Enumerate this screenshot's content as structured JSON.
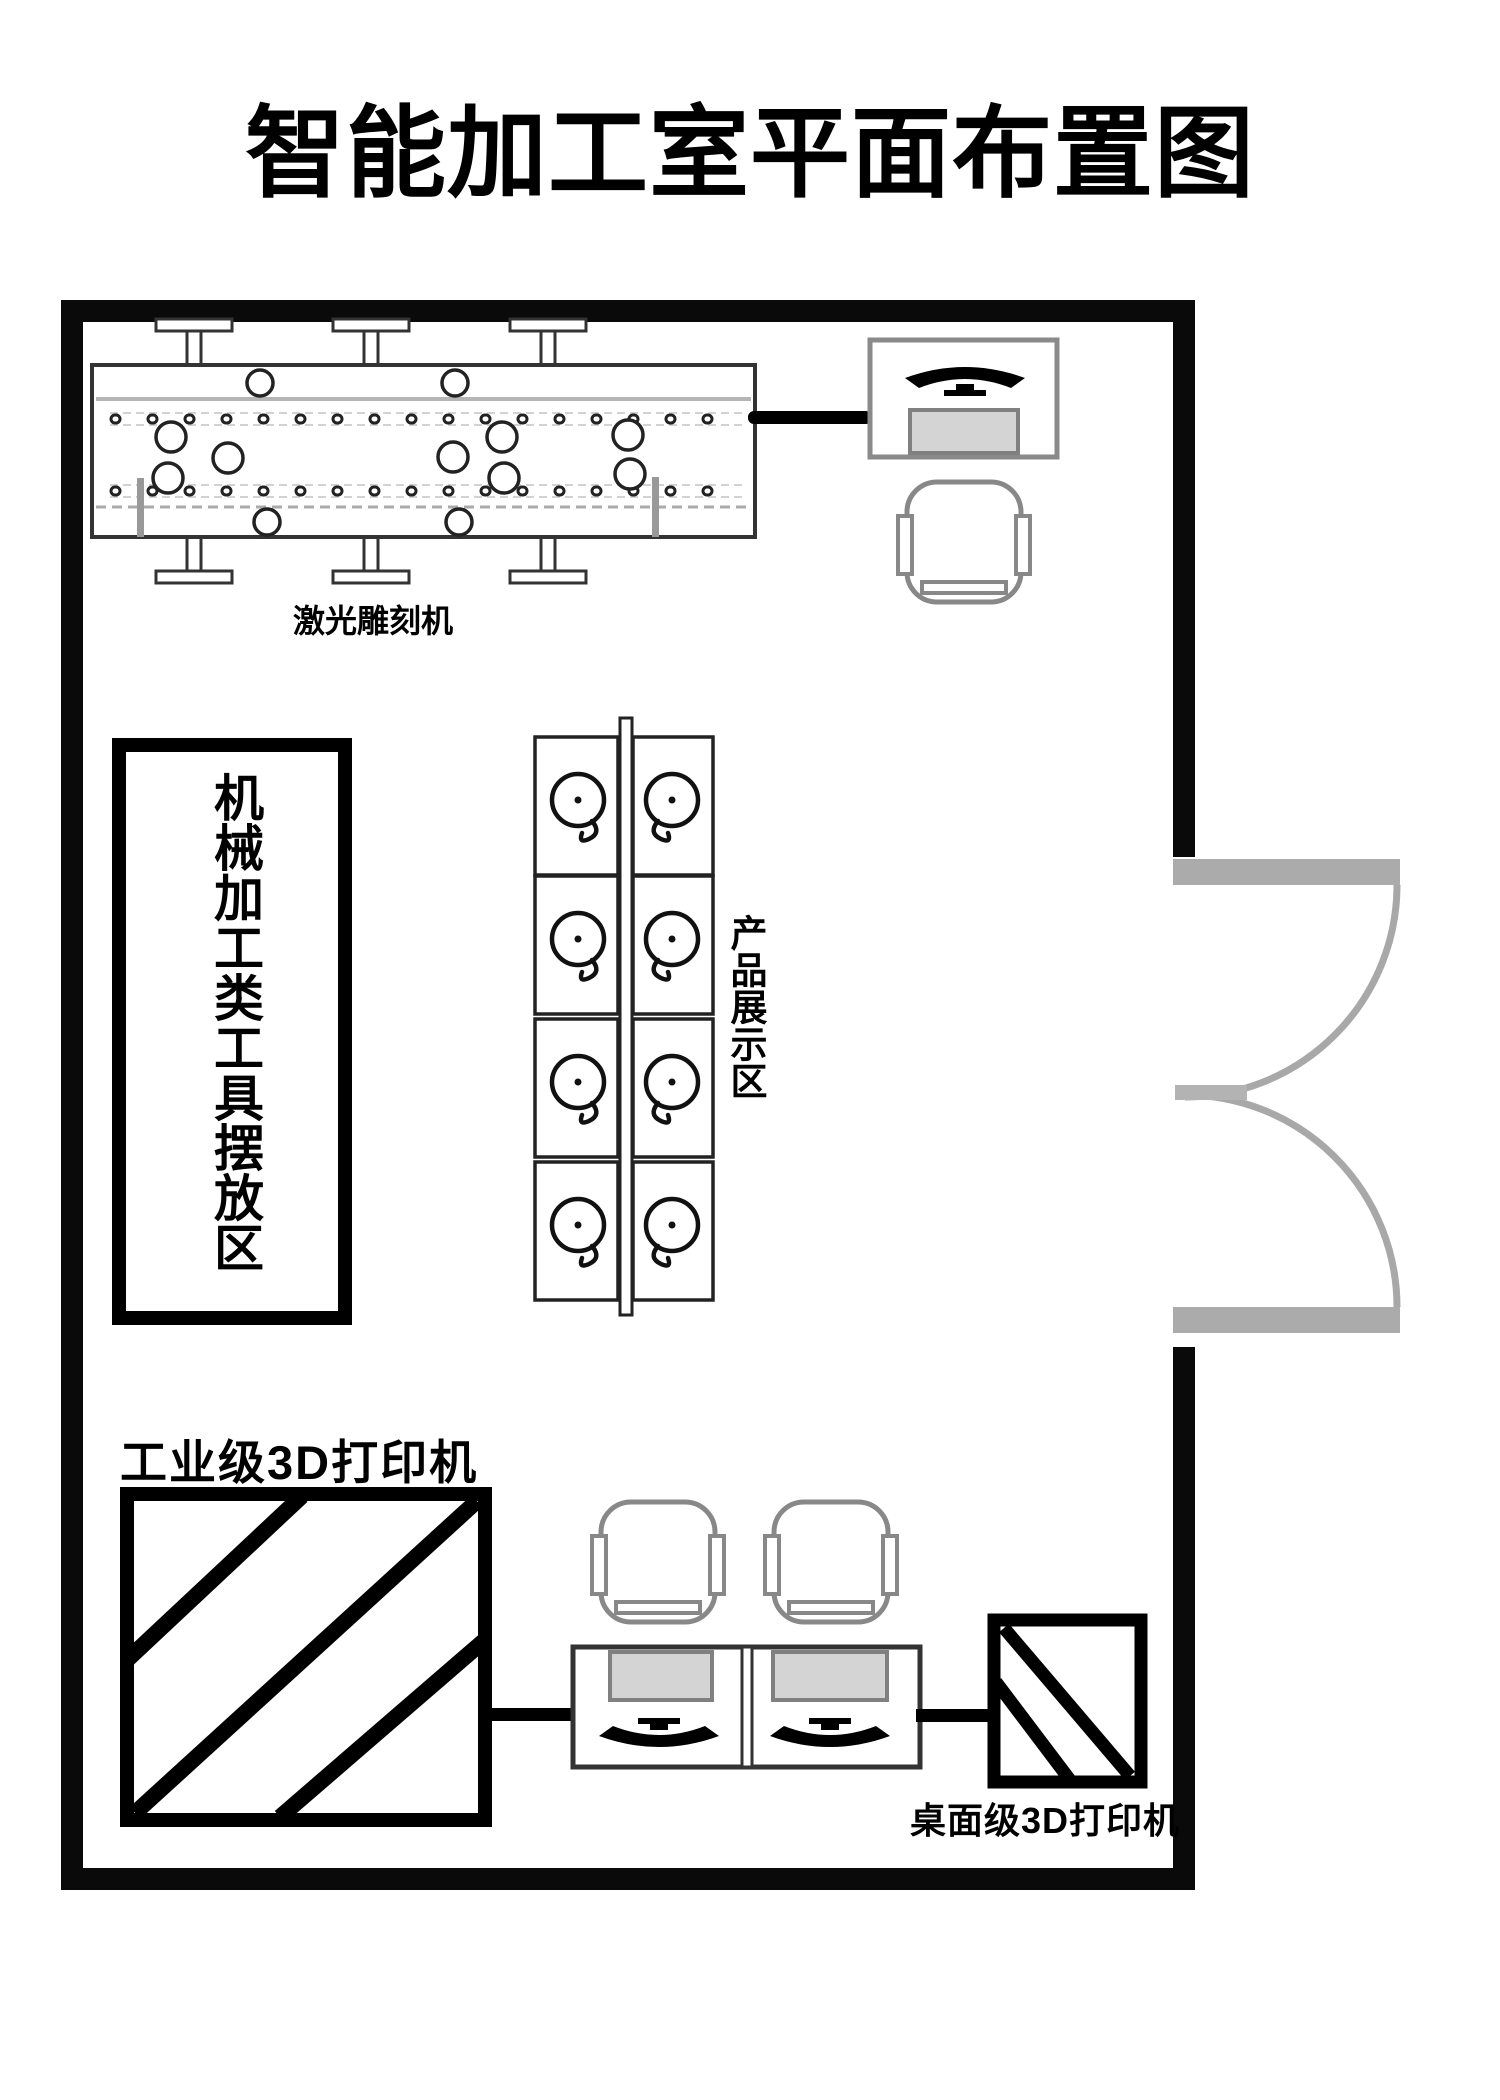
{
  "title": "智能加工室平面布置图",
  "labels": {
    "laser_engraver": "激光雕刻机",
    "tool_storage": "机械加工类工具摆放区",
    "product_display": "产品展示区",
    "industrial_printer": "工业级3D打印机",
    "desktop_printer": "桌面级3D打印机"
  },
  "floor_plan": {
    "room_shape": "rectangular",
    "door": {
      "type": "double-swing",
      "wall": "right",
      "state": "shown-open"
    },
    "equipment": [
      {
        "id": "laser-engraver",
        "label": "激光雕刻机",
        "position": "top-left",
        "supports": 3,
        "feet": 3
      },
      {
        "id": "operator-desk",
        "items": [
          "monitor",
          "keyboard",
          "chair"
        ],
        "position": "top-right"
      },
      {
        "id": "tool-storage-zone",
        "label": "机械加工类工具摆放区",
        "position": "left"
      },
      {
        "id": "product-display-zone",
        "label": "产品展示区",
        "position": "center",
        "stool_count": 8,
        "rows": 4,
        "columns": 2
      },
      {
        "id": "industrial-3d-printer",
        "label": "工业级3D打印机",
        "position": "bottom-left",
        "hatch_stripes": 3
      },
      {
        "id": "workstation-desks",
        "desk_count": 2,
        "items": [
          "monitor",
          "keyboard"
        ],
        "chair_count": 2,
        "position": "bottom-center"
      },
      {
        "id": "desktop-3d-printer",
        "label": "桌面级3D打印机",
        "position": "bottom-right",
        "hatch_stripes": 2
      }
    ],
    "colors": {
      "wall": "#0a0a0a",
      "line_dark": "#222222",
      "furniture_gray": "#8a8a8a",
      "door_gray": "#a8a8a8",
      "fill": "#ffffff"
    }
  }
}
